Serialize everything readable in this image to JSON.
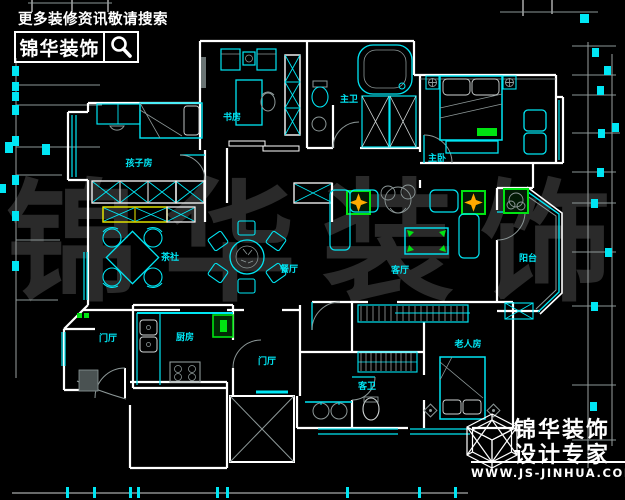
{
  "header": {
    "tagline": "更多装修资讯敬请搜索",
    "brand": "锦华装饰",
    "search_icon": "magnifier"
  },
  "footer": {
    "brand": "锦华装饰",
    "subtitle": "设计专家",
    "website": "WWW.JS-JINHUA.COM",
    "logo": "wireframe-cube"
  },
  "watermark": {
    "text": "锦华装饰"
  },
  "floorplan": {
    "rooms": [
      {
        "id": "study",
        "label": "书房"
      },
      {
        "id": "master-bath",
        "label": "主卫"
      },
      {
        "id": "master-bedroom",
        "label": "主卧"
      },
      {
        "id": "kids-room",
        "label": "孩子房"
      },
      {
        "id": "tea-room",
        "label": "茶社"
      },
      {
        "id": "dining-room",
        "label": "餐厅"
      },
      {
        "id": "living-room",
        "label": "客厅"
      },
      {
        "id": "balcony",
        "label": "阳台"
      },
      {
        "id": "hall-west",
        "label": "门厅"
      },
      {
        "id": "kitchen",
        "label": "厨房"
      },
      {
        "id": "hall-center",
        "label": "门厅"
      },
      {
        "id": "guest-bath",
        "label": "客卫"
      },
      {
        "id": "elderly-room",
        "label": "老人房"
      }
    ],
    "colors": {
      "background": "#000000",
      "walls": "#ffffff",
      "fixtures": "#00e6f4",
      "details": "#8d9898",
      "accent_green": "#00e412",
      "accent_yellow": "#f0f000",
      "accent_orange": "#ffaa00",
      "label_text": "#00e6f4",
      "watermark": "#2a2a2a"
    }
  }
}
